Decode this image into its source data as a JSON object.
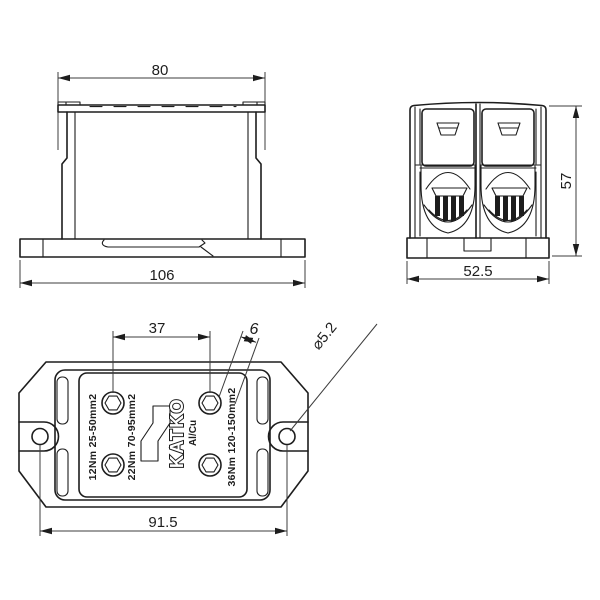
{
  "drawing": {
    "front_view": {
      "dim_top_width": "80",
      "dim_base_width": "106"
    },
    "side_view": {
      "dim_height": "57",
      "dim_depth": "52.5"
    },
    "top_view": {
      "dim_screw_spacing": "37",
      "dim_hex": "6",
      "dim_hole_dia": "⌀5.2",
      "dim_hole_spacing": "91.5",
      "label_left": "12Nm 25-50mm2",
      "label_mid": "22Nm 70-95mm2",
      "label_right": "36Nm 120-150mm2",
      "brand": "KATKO",
      "material": "Al/Cu"
    },
    "colors": {
      "line": "#1d1d1d",
      "background": "#ffffff"
    }
  }
}
